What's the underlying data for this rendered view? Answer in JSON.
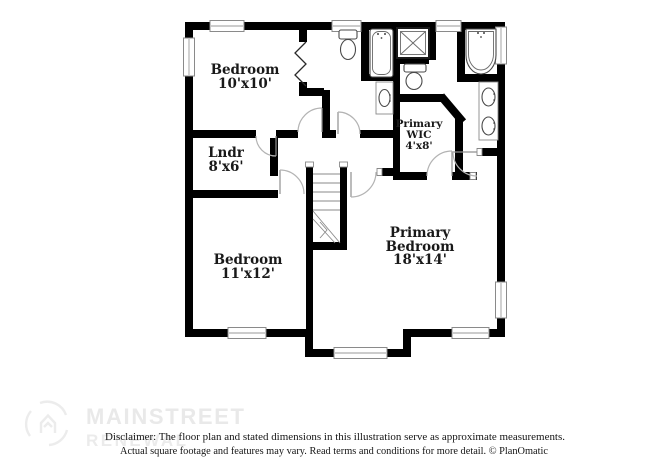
{
  "image": {
    "width": 650,
    "height": 473,
    "background": "#ffffff"
  },
  "floor_plan": {
    "rooms": {
      "bedroom1": {
        "name": "Bedroom",
        "dims": "10'x10'"
      },
      "laundry": {
        "name": "Lndr",
        "dims": "8'x6'"
      },
      "bedroom2": {
        "name": "Bedroom",
        "dims": "11'x12'"
      },
      "primary_wic": {
        "line1": "Primary",
        "line2": "WIC",
        "dims": "4'x8'"
      },
      "primary_bedroom": {
        "line1": "Primary",
        "line2": "Bedroom",
        "dims": "18'x14'"
      }
    },
    "fixtures": [
      "toilet",
      "bathtub",
      "sink-vanity",
      "shower",
      "garden-tub",
      "double-vanity",
      "stairs",
      "bifold-closet-doors"
    ],
    "colors": {
      "wall": "#000000",
      "label": "#191919",
      "door_swing": "#b3b3b3",
      "window_frame": "#8a8a8a",
      "fixture": "#4a4a4a",
      "watermark": "#e9e9e9",
      "disclaimer_text": "#151515"
    }
  },
  "watermark": {
    "brand_line1": "MAINSTREET",
    "brand_line2": "RENEWAL"
  },
  "footer": {
    "disclaimer_line1": "Disclaimer: The floor plan and stated dimensions in this illustration serve as approximate measurements.",
    "disclaimer_line2": "Actual square footage and features may vary. Read terms and conditions for more detail. © PlanOmatic"
  }
}
